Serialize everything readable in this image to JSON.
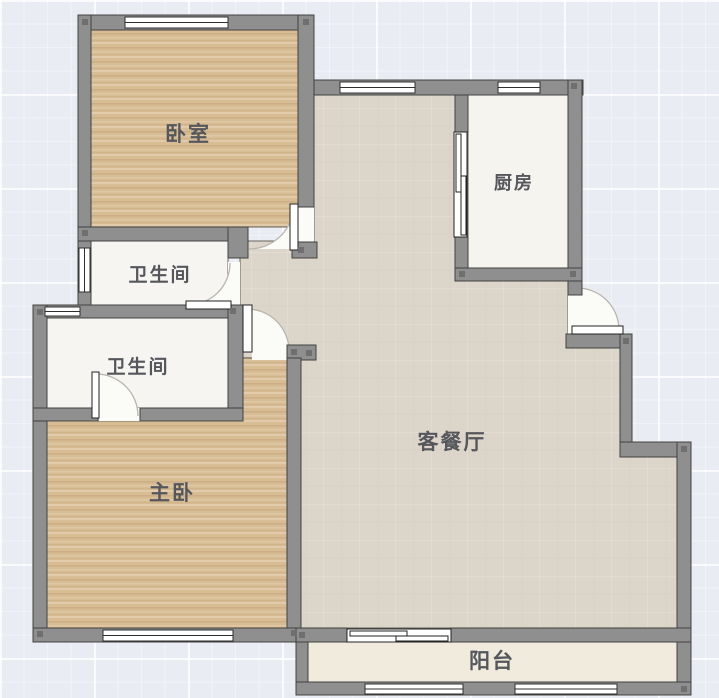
{
  "floorplan": {
    "rooms": [
      {
        "id": "bedroom",
        "label": "卧室"
      },
      {
        "id": "bathroom-upper",
        "label": "卫生间"
      },
      {
        "id": "bathroom-lower",
        "label": "卫生间"
      },
      {
        "id": "master-bedroom",
        "label": "主卧"
      },
      {
        "id": "living-dining",
        "label": "客餐厅"
      },
      {
        "id": "kitchen",
        "label": "厨房"
      },
      {
        "id": "balcony",
        "label": "阳台"
      }
    ],
    "colors": {
      "wall": "#8f8f8f",
      "wall_outline": "#424242",
      "wood_floor": "#d8bd94",
      "living_floor": "#dcd5ca",
      "white_floor": "#f6f5f2",
      "balcony_floor": "#f0ebdd",
      "background": "#e9edf3",
      "label_text": "#56575c"
    }
  }
}
